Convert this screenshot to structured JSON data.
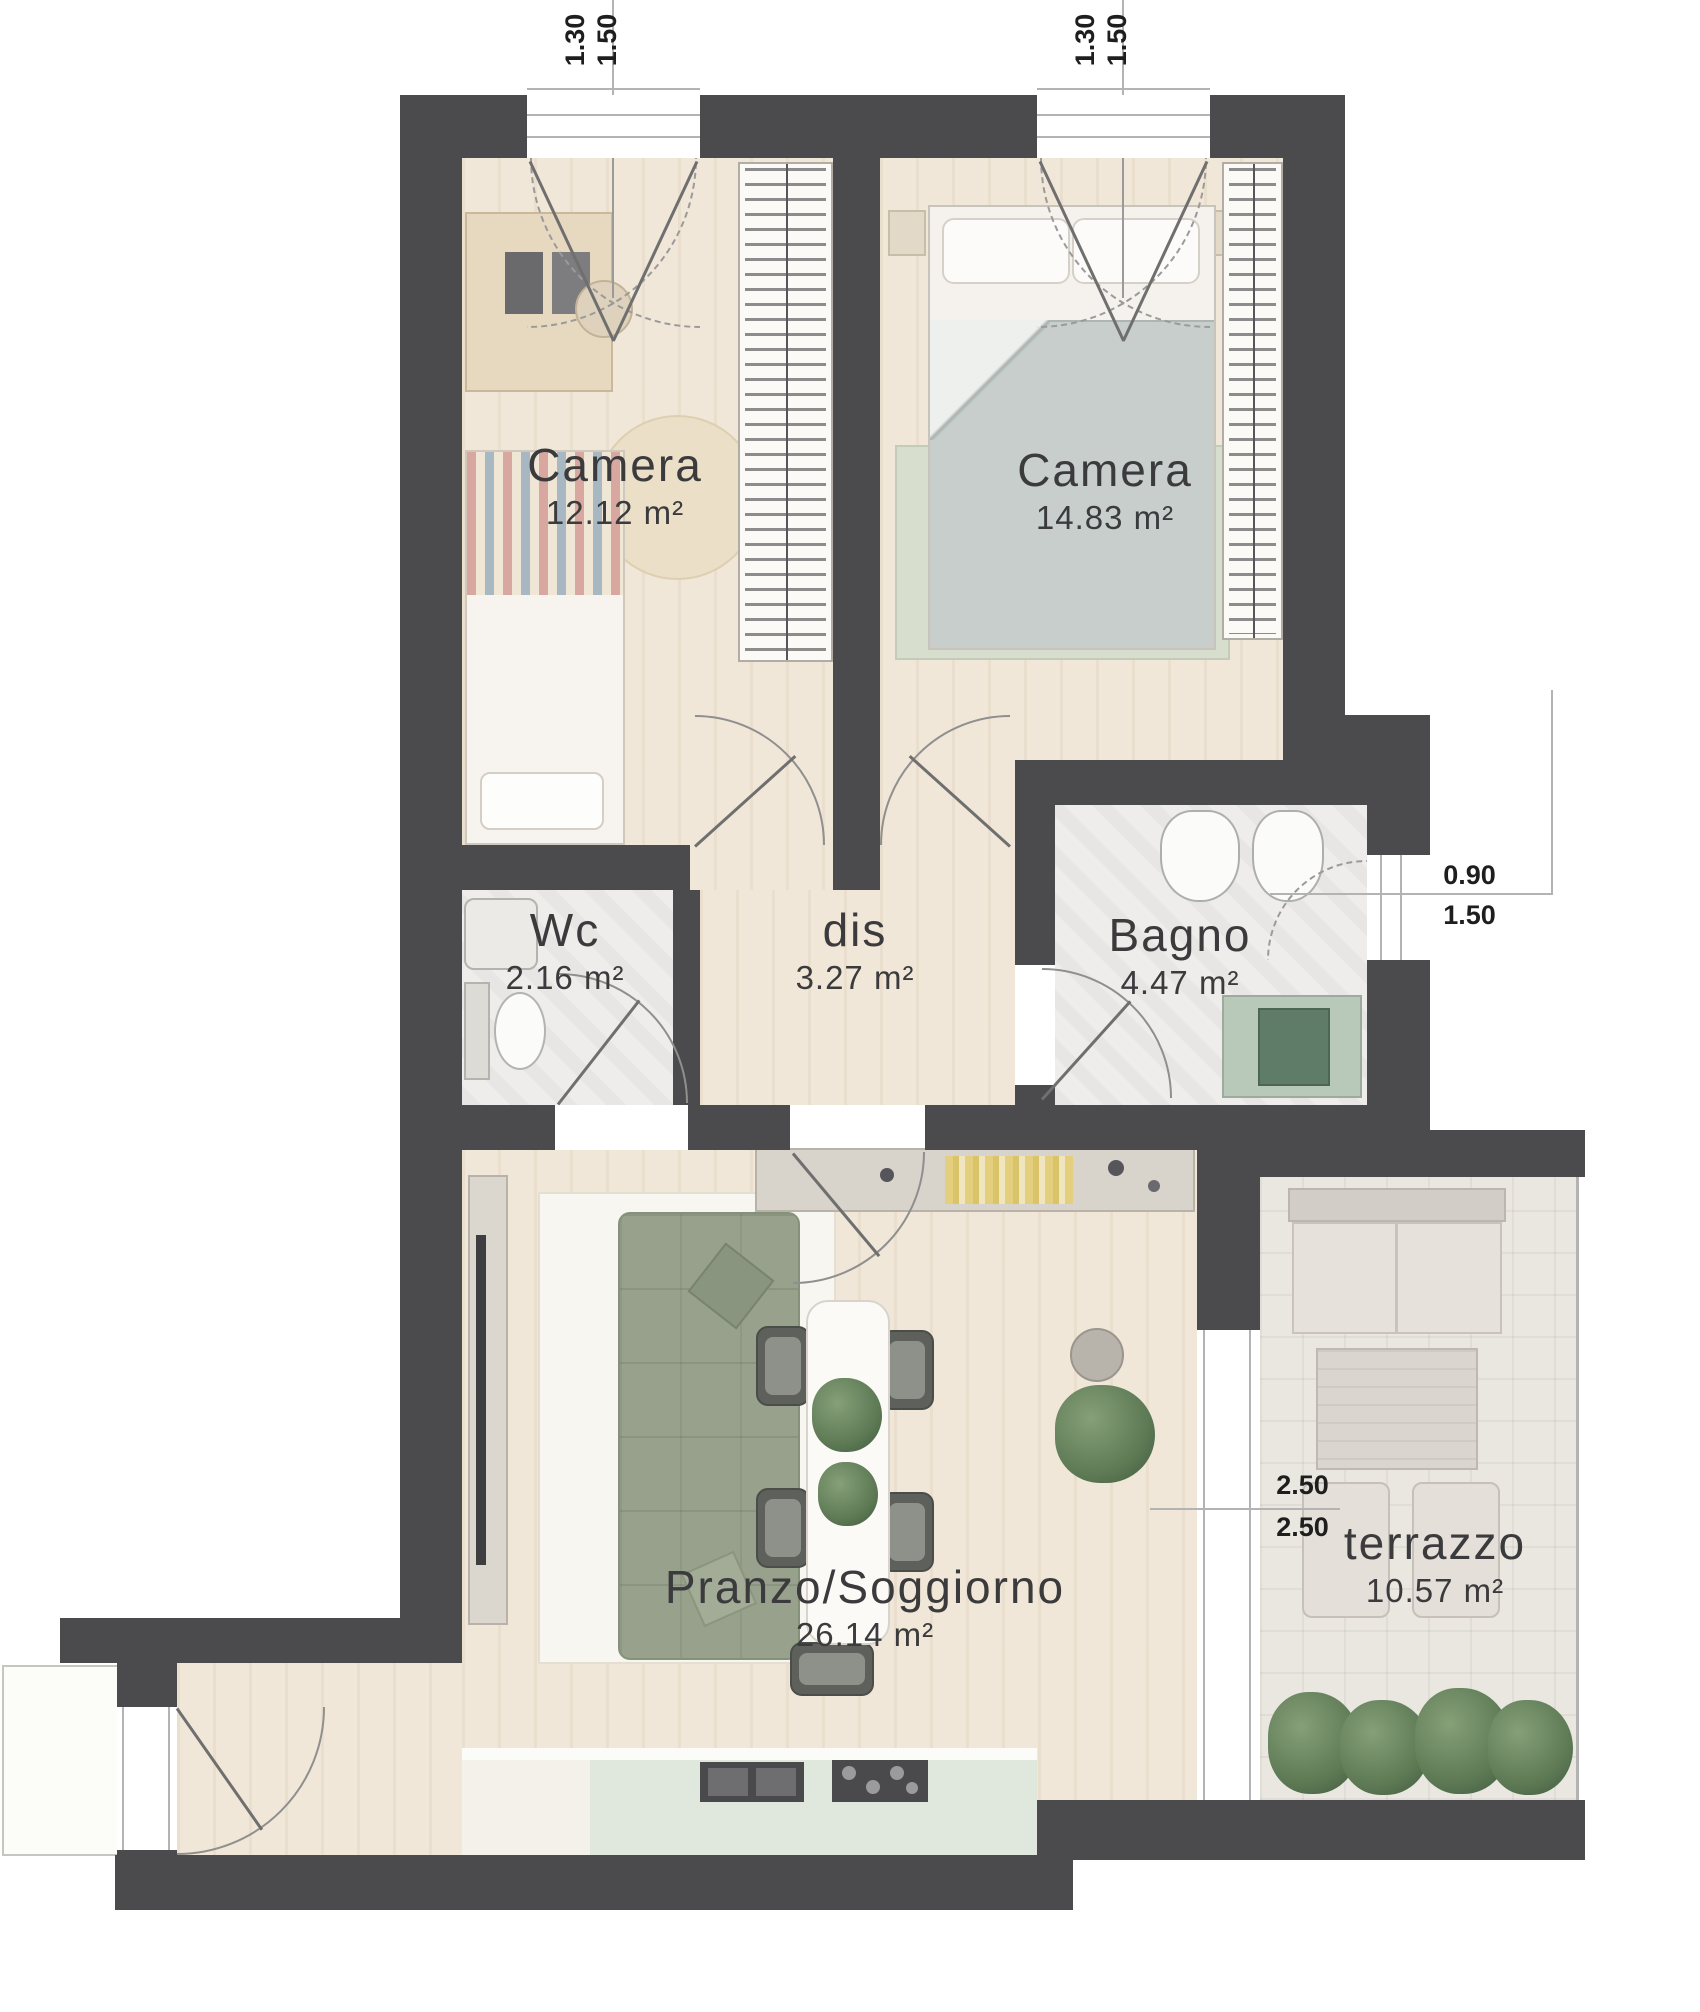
{
  "rooms": [
    {
      "name": "Camera",
      "area": "12.12 m²"
    },
    {
      "name": "Camera",
      "area": "14.83 m²"
    },
    {
      "name": "Wc",
      "area": "2.16 m²"
    },
    {
      "name": "dis",
      "area": "3.27 m²"
    },
    {
      "name": "Bagno",
      "area": "4.47 m²"
    },
    {
      "name": "Pranzo/Soggiorno",
      "area": "26.14 m²"
    },
    {
      "name": "terrazzo",
      "area": "10.57 m²"
    }
  ],
  "dimensions": {
    "top_window_left": {
      "width": "1.30",
      "height": "1.50"
    },
    "top_window_right": {
      "width": "1.30",
      "height": "1.50"
    },
    "bagno_window": {
      "width": "0.90",
      "height": "1.50"
    },
    "terrace_door": {
      "width": "2.50",
      "height": "2.50"
    }
  },
  "colors": {
    "wall": "#4b4b4d",
    "wood_floor": "#f1e7d8",
    "stone_floor": "#eeedeb",
    "terrace_floor": "#e9e7e0",
    "sofa": "#97a18c",
    "shower": "#b9c9b9",
    "plant": "#5d7a55",
    "kitchen_counter": "#e0e7dd",
    "bed_duvet": "#c7cecb",
    "rug_green": "#d7decd"
  }
}
